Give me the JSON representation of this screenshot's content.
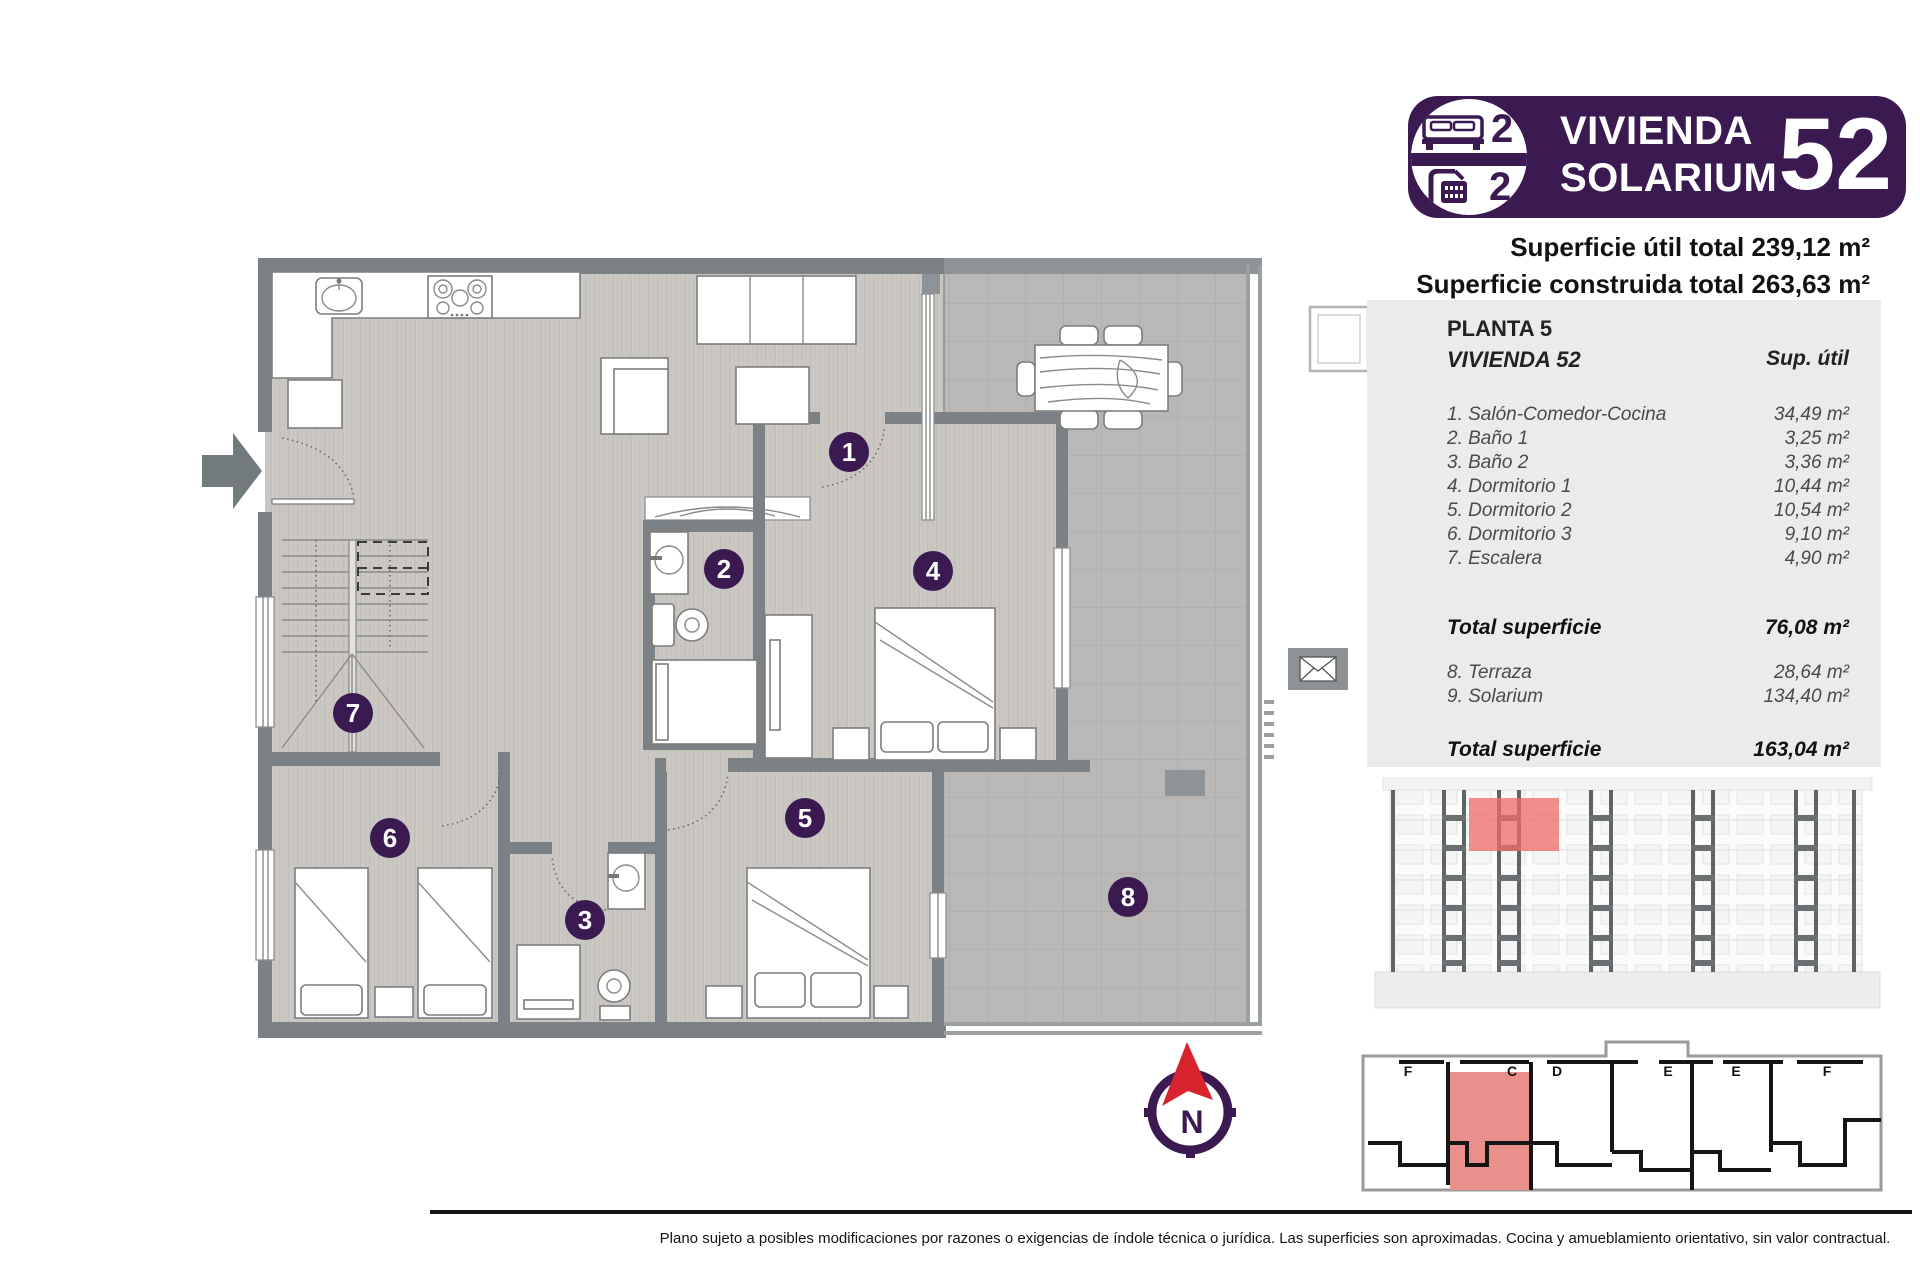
{
  "header": {
    "bedrooms_count": "2",
    "bathrooms_count": "2",
    "title_line1": "VIVIENDA",
    "title_line2": "SOLARIUM",
    "unit_number": "52",
    "superficie_util": "Superficie útil total 239,12 m²",
    "superficie_construida": "Superficie construida total 263,63 m²"
  },
  "panel": {
    "floor": "PLANTA 5",
    "unit": "VIVIENDA 52",
    "col_header": "Sup. útil",
    "rooms": [
      {
        "label": "1. Salón-Comedor-Cocina",
        "value": "34,49 m²"
      },
      {
        "label": "2. Baño 1",
        "value": "3,25 m²"
      },
      {
        "label": "3. Baño 2",
        "value": "3,36 m²"
      },
      {
        "label": "4. Dormitorio 1",
        "value": "10,44 m²"
      },
      {
        "label": "5. Dormitorio 2",
        "value": "10,54 m²"
      },
      {
        "label": "6. Dormitorio 3",
        "value": "9,10 m²"
      },
      {
        "label": "7. Escalera",
        "value": "4,90 m²"
      }
    ],
    "total1_label": "Total superficie",
    "total1_value": "76,08 m²",
    "extras": [
      {
        "label": "8. Terraza",
        "value": "28,64 m²"
      },
      {
        "label": "9. Solarium",
        "value": "134,40 m²"
      }
    ],
    "total2_label": "Total superficie",
    "total2_value": "163,04 m²"
  },
  "plan": {
    "badges": [
      {
        "n": "1"
      },
      {
        "n": "2"
      },
      {
        "n": "3"
      },
      {
        "n": "4"
      },
      {
        "n": "5"
      },
      {
        "n": "6"
      },
      {
        "n": "7"
      },
      {
        "n": "8"
      }
    ]
  },
  "keyplan": {
    "labels": [
      "F",
      "C",
      "D",
      "E",
      "E",
      "F"
    ]
  },
  "compass": {
    "north": "N"
  },
  "footer": {
    "disclaimer": "Plano sujeto a posibles modificaciones por razones o exigencias de índole técnica o jurídica. Las superficies son aproximadas. Cocina y amueblamiento orientativo, sin valor contractual."
  },
  "colors": {
    "brand_purple": "#3b1a52",
    "highlight_red": "#ef6b66",
    "wall_gray": "#7b8184",
    "panel_bg": "#e9ece9"
  }
}
